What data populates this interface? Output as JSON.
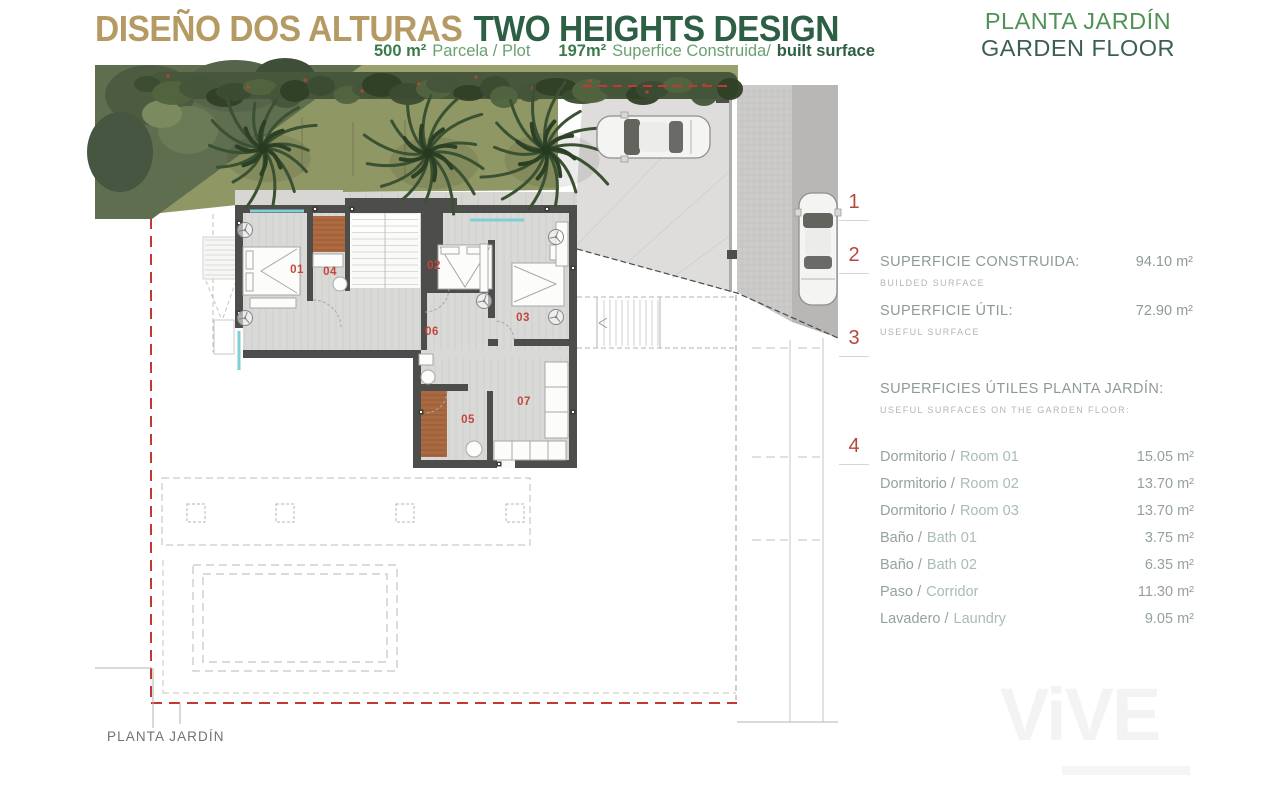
{
  "header": {
    "title_es": "DISEÑO DOS ALTURAS",
    "title_en": "TWO HEIGHTS DESIGN",
    "subtitle": {
      "plot_value": "500 m²",
      "plot_label": "Parcela / Plot",
      "built_value": "197m²",
      "built_label_es": "Superfice Construida/",
      "built_label_en": "built surface"
    },
    "floor_es": "PLANTA JARDÍN",
    "floor_en": "GARDEN FLOOR"
  },
  "plan": {
    "caption": "PLANTA JARDÍN",
    "rooms": [
      {
        "num": "01"
      },
      {
        "num": "04"
      },
      {
        "num": "02"
      },
      {
        "num": "03"
      },
      {
        "num": "06"
      },
      {
        "num": "05"
      },
      {
        "num": "07"
      }
    ]
  },
  "panel": {
    "markers": [
      {
        "num": "1"
      },
      {
        "num": "2"
      },
      {
        "num": "3"
      },
      {
        "num": "4"
      }
    ],
    "built": {
      "label": "SUPERFICIE CONSTRUIDA:",
      "sub": "BUILDED SURFACE",
      "value": "94.10 m²"
    },
    "useful": {
      "label": "SUPERFICIE ÚTIL:",
      "sub": "USEFUL SURFACE",
      "value": "72.90 m²"
    },
    "section": {
      "label": "SUPERFICIES ÚTILES PLANTA JARDÍN:",
      "sub": "USEFUL SURFACES ON THE GARDEN FLOOR:"
    },
    "rows": [
      {
        "es": "Dormitorio /",
        "en": "Room 01",
        "value": "15.05 m²"
      },
      {
        "es": "Dormitorio /",
        "en": "Room 02",
        "value": "13.70 m²"
      },
      {
        "es": "Dormitorio /",
        "en": "Room 03",
        "value": "13.70 m²"
      },
      {
        "es": "Baño /",
        "en": "Bath 01",
        "value": "3.75 m²"
      },
      {
        "es": "Baño /",
        "en": "Bath 02",
        "value": "6.35 m²"
      },
      {
        "es": "Paso /",
        "en": "Corridor",
        "value": "11.30 m²"
      },
      {
        "es": "Lavadero /",
        "en": "Laundry",
        "value": "9.05 m²"
      }
    ]
  },
  "watermark": "ViVE",
  "colors": {
    "title_gold": "#b59b63",
    "title_green": "#2d5f45",
    "green_mid": "#4f9156",
    "green_dark": "#3b604d",
    "red_marker": "#b5473e",
    "red_plan": "#c2463c",
    "boundary_red": "#c03a31",
    "text_gray": "#8f9a95",
    "text_light": "#aeb8b3",
    "text_green_light": "#a9bdb2",
    "teal_window": "#7fd0d6",
    "lawn": "#8f9765",
    "hedge": "#46573b",
    "wall": "#4d4d4b",
    "floor": "#d9d9d7",
    "bath_floor": "#ae6a40"
  }
}
